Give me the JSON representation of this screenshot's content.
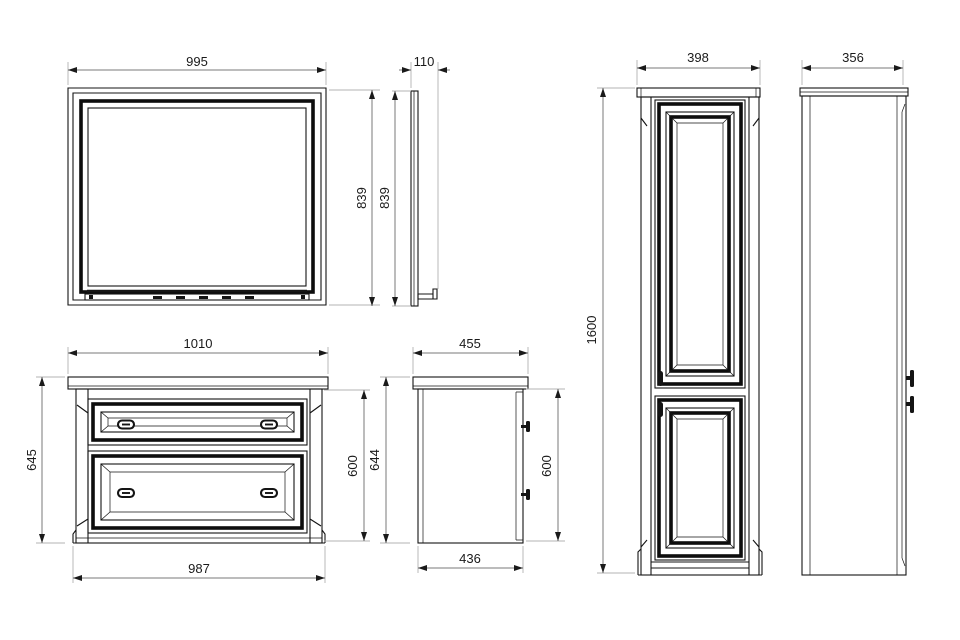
{
  "drawing": {
    "colors": {
      "object_line": "#141414",
      "dimension_line": "#7a7a7a",
      "extension_line": "#b3b3b3",
      "label_text": "#1a1a1a",
      "background": "#ffffff"
    },
    "views": {
      "mirror_front": {
        "label_width": "995"
      },
      "mirror_side": {
        "label_depth": "110",
        "label_height_outer": "839",
        "label_height_inner": "839"
      },
      "vanity_front": {
        "label_width_top": "1010",
        "label_height": "645",
        "label_body_height": "600",
        "label_width_bottom": "987"
      },
      "vanity_side": {
        "label_depth_top": "455",
        "label_height": "644",
        "label_body_height": "600",
        "label_depth_bottom": "436"
      },
      "tall_cabinet_front": {
        "label_width": "398",
        "label_height": "1600"
      },
      "tall_cabinet_side": {
        "label_depth": "356"
      }
    }
  }
}
